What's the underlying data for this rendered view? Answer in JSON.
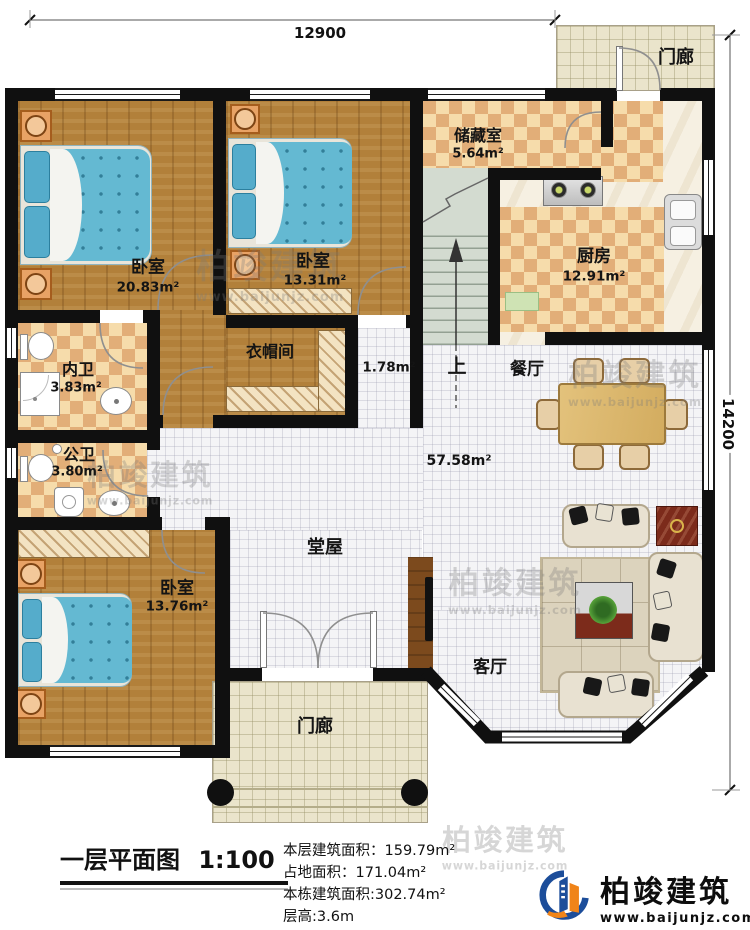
{
  "dimensions": {
    "width_label": "12900",
    "height_label": "14200"
  },
  "rooms": {
    "porch_top": "门廊",
    "storage": "储藏室",
    "storage_area": "5.64m²",
    "kitchen": "厨房",
    "kitchen_area": "12.91m²",
    "bedroom1": "卧室",
    "bedroom1_area": "20.83m²",
    "bedroom2": "卧室",
    "bedroom2_area": "13.31m²",
    "inner_bath": "内卫",
    "inner_bath_area": "3.83m²",
    "cloakroom": "衣帽间",
    "corridor_area": "1.78m²",
    "stairs_up": "上",
    "dining": "餐厅",
    "hall_area": "57.58m²",
    "public_bath": "公卫",
    "public_bath_area": "3.80m²",
    "main_hall": "堂屋",
    "bedroom3": "卧室",
    "bedroom3_area": "13.76m²",
    "living": "客厅",
    "porch_bottom": "门廊"
  },
  "title_block": {
    "title": "一层平面图",
    "scale": "1:100",
    "stats": [
      "本层建筑面积：159.79m²",
      "占地面积：171.04m²",
      "本栋建筑面积:302.74m²",
      "层高:3.6m"
    ]
  },
  "logo": {
    "name": "柏竣建筑",
    "url": "www.baijunjz.com"
  },
  "watermark": {
    "name": "柏竣建筑",
    "url": "www.baijunjz.com"
  }
}
